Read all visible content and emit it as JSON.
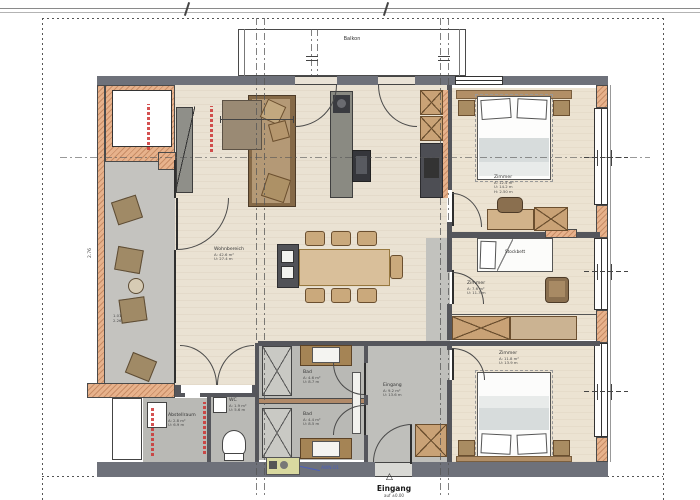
{
  "plan_type": "apartment-floor-plan",
  "balcony": {
    "label": "Balkon"
  },
  "rooms": {
    "wohnbereich": {
      "name": "Wohnbereich",
      "l1": "A: 42.6 m²",
      "l2": "U: 27.4 m"
    },
    "zimmer1": {
      "name": "Zimmer",
      "l1": "A: 12.4 m²",
      "l2": "U: 14.2 m",
      "l3": "H: 2.50 m"
    },
    "zimmer2": {
      "name": "Zimmer",
      "l1": "A: 7.6 m²",
      "l2": "U: 11.3 m"
    },
    "zimmer3": {
      "name": "Zimmer",
      "l1": "A: 11.8 m²",
      "l2": "U: 13.9 m"
    },
    "bad1": {
      "name": "Bad",
      "l1": "A: 4.6 m²",
      "l2": "U: 8.7 m"
    },
    "bad2": {
      "name": "Bad",
      "l1": "A: 4.4 m²",
      "l2": "U: 8.5 m"
    },
    "wc": {
      "name": "WC",
      "l1": "A: 1.9 m²",
      "l2": "U: 5.6 m"
    },
    "abstellraum": {
      "name": "Abstellraum",
      "l1": "A: 2.8 m²",
      "l2": "U: 6.9 m"
    },
    "eingang": {
      "name": "Eingang",
      "l1": "A: 9.2 m²",
      "l2": "U: 13.6 m"
    }
  },
  "furniture_labels": {
    "bunk_bed": "Stockbett"
  },
  "entrance_marker": {
    "label": "Eingang",
    "sub": "auf ±0.00",
    "triangle": "△"
  },
  "tech_unit": {
    "label": "AWN.01"
  },
  "dimensions": {
    "left_wall": "2.76",
    "terrace_b": "1.01",
    "terrace_h": "2.26"
  },
  "colors": {
    "wall_gray": "#6e717a",
    "insulated_wall": "#e7b28c",
    "wood_floor": "#eae2d3",
    "terrace_floor": "#c4c3bf",
    "bath_floor": "#b9b9b5",
    "annotation_red": "#cc3333",
    "annotation_blue": "#4a5fc0",
    "furniture_brown": "#a98c62"
  }
}
